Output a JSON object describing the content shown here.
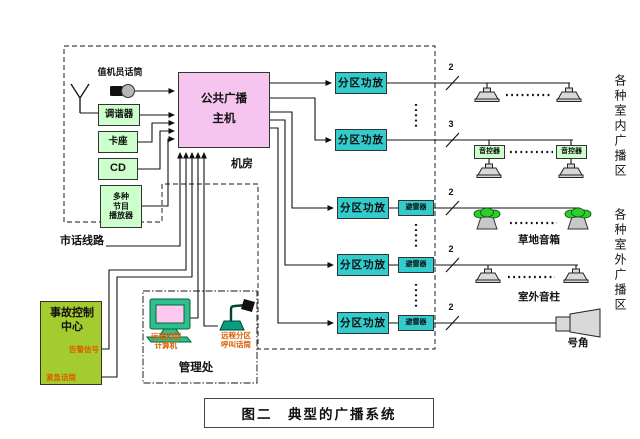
{
  "figure": {
    "caption": "图二　典型的广播系统"
  },
  "room": {
    "label": "机房"
  },
  "sources": {
    "operator_mic_label": "值机员话筒",
    "tuner": "调谐器",
    "cassette": "卡座",
    "cd": "CD",
    "player": "多种\n节目\n播放器"
  },
  "main_unit": {
    "label": "公共广播\n主机"
  },
  "city_line": {
    "label": "市话线路"
  },
  "accident_center": {
    "title": "事故控制\n中心",
    "alarm_signal": "告警信号",
    "emergency_mic": "紧急话筒"
  },
  "management": {
    "label": "管理处",
    "computer": "远程控制\n计算机",
    "remote_mic": "远程分区\n呼叫话筒"
  },
  "amplifiers": {
    "label": "分区功放",
    "arrester": "避雷器",
    "volume_controller": "音控器"
  },
  "wire_counts": [
    "2",
    "3",
    "2",
    "2",
    "2"
  ],
  "outdoor_items": {
    "lawn": "草地音箱",
    "column": "室外音柱",
    "horn": "号角"
  },
  "zones": {
    "indoor": "各种室内广播区",
    "outdoor": "各种室外广播区"
  },
  "colors": {
    "source_box": "#ccffcc",
    "main_unit": "#f5c4ef",
    "amplifier": "#33cccc",
    "accident_center": "#a4cc2e",
    "accent_text": "#d95f00",
    "lawn_speaker_green": "#2ecc2e"
  }
}
